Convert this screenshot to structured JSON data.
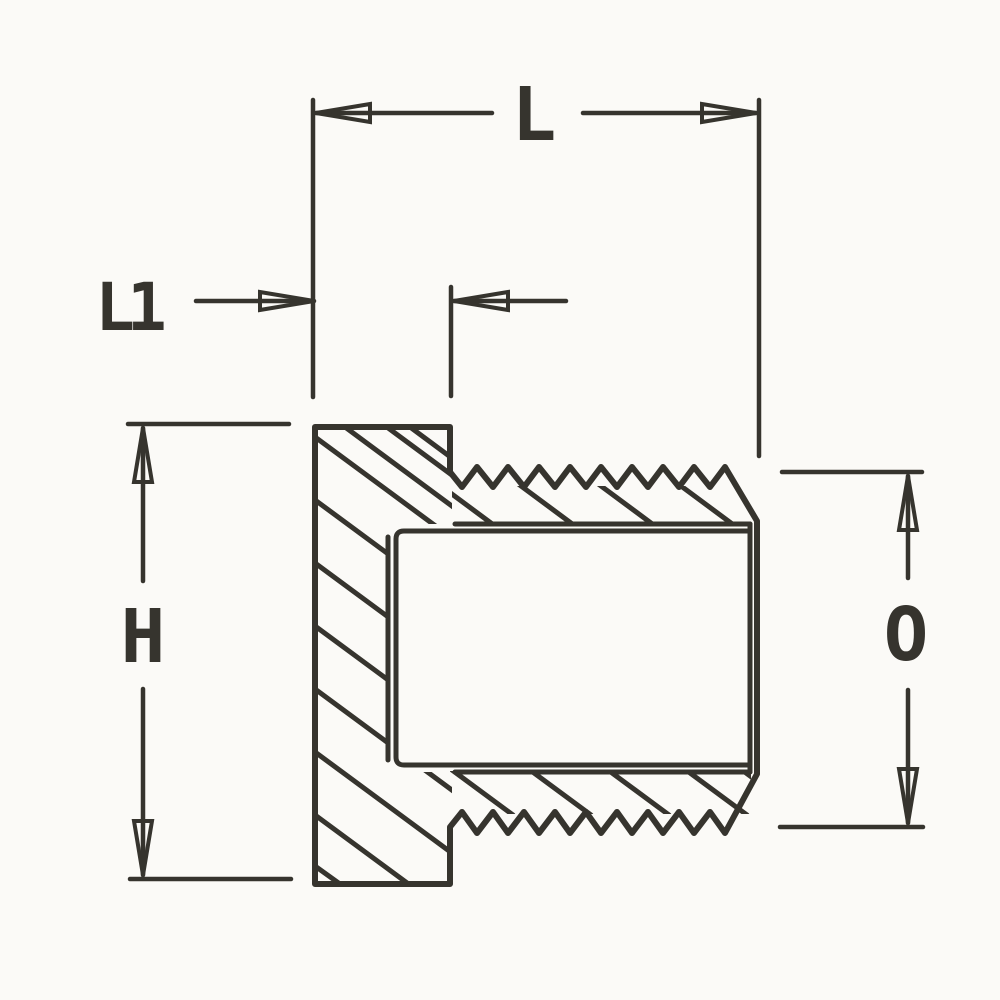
{
  "drawing": {
    "kind": "technical-cross-section",
    "labels": {
      "overall_length": "L",
      "head_length": "L1",
      "head_height": "H",
      "thread_outside_diameter": "O"
    },
    "colors": {
      "ink": "#36342e",
      "background": "#fbfaf7"
    }
  }
}
